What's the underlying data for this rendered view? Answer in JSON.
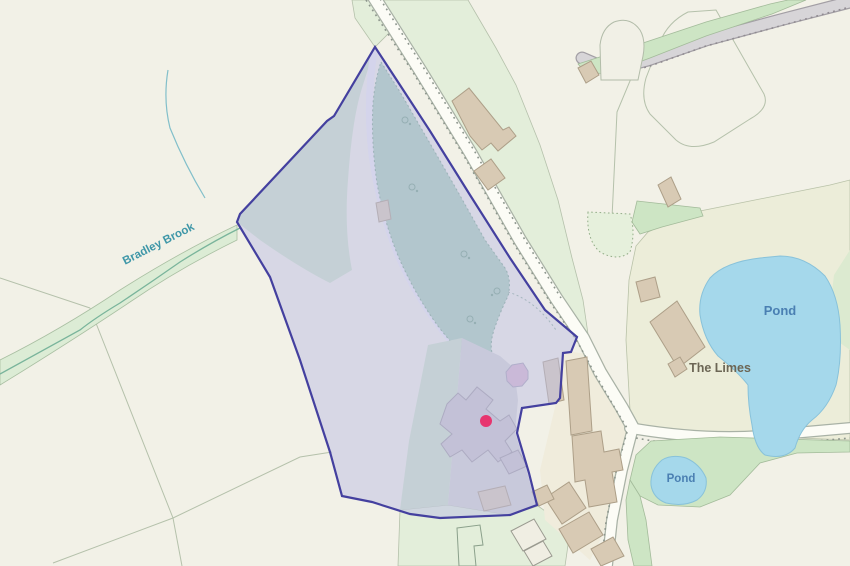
{
  "map": {
    "labels": {
      "bradley_brook": "Bradley Brook",
      "pond_upper": "Pond",
      "the_limes": "The Limes",
      "pond_lower": "Pond"
    },
    "marker": {
      "name": "property-location-marker",
      "shape": "dot"
    },
    "colors": {
      "background": "#f2f1e7",
      "field_green": "#e3eeda",
      "field_line": "#b5c1ab",
      "verge_green": "#cde5c4",
      "woodland": "#a9ceb7",
      "water": "#a5d8eb",
      "water_label": "#4a7fb2",
      "stream_label": "#3f97a8",
      "place_label": "#6c6655",
      "road_fill": "#fcfcf6",
      "road_casing": "#a9b2a6",
      "track_grey": "#d7d5d8",
      "building_tan": "#d8cab4",
      "building_grey": "#cac5ca",
      "boundary": "#44409f",
      "boundary_fill": "rgba(187,189,228,0.5)",
      "marker_pink": "#e7356f",
      "octagon_pink": "#d9b4cc"
    }
  }
}
